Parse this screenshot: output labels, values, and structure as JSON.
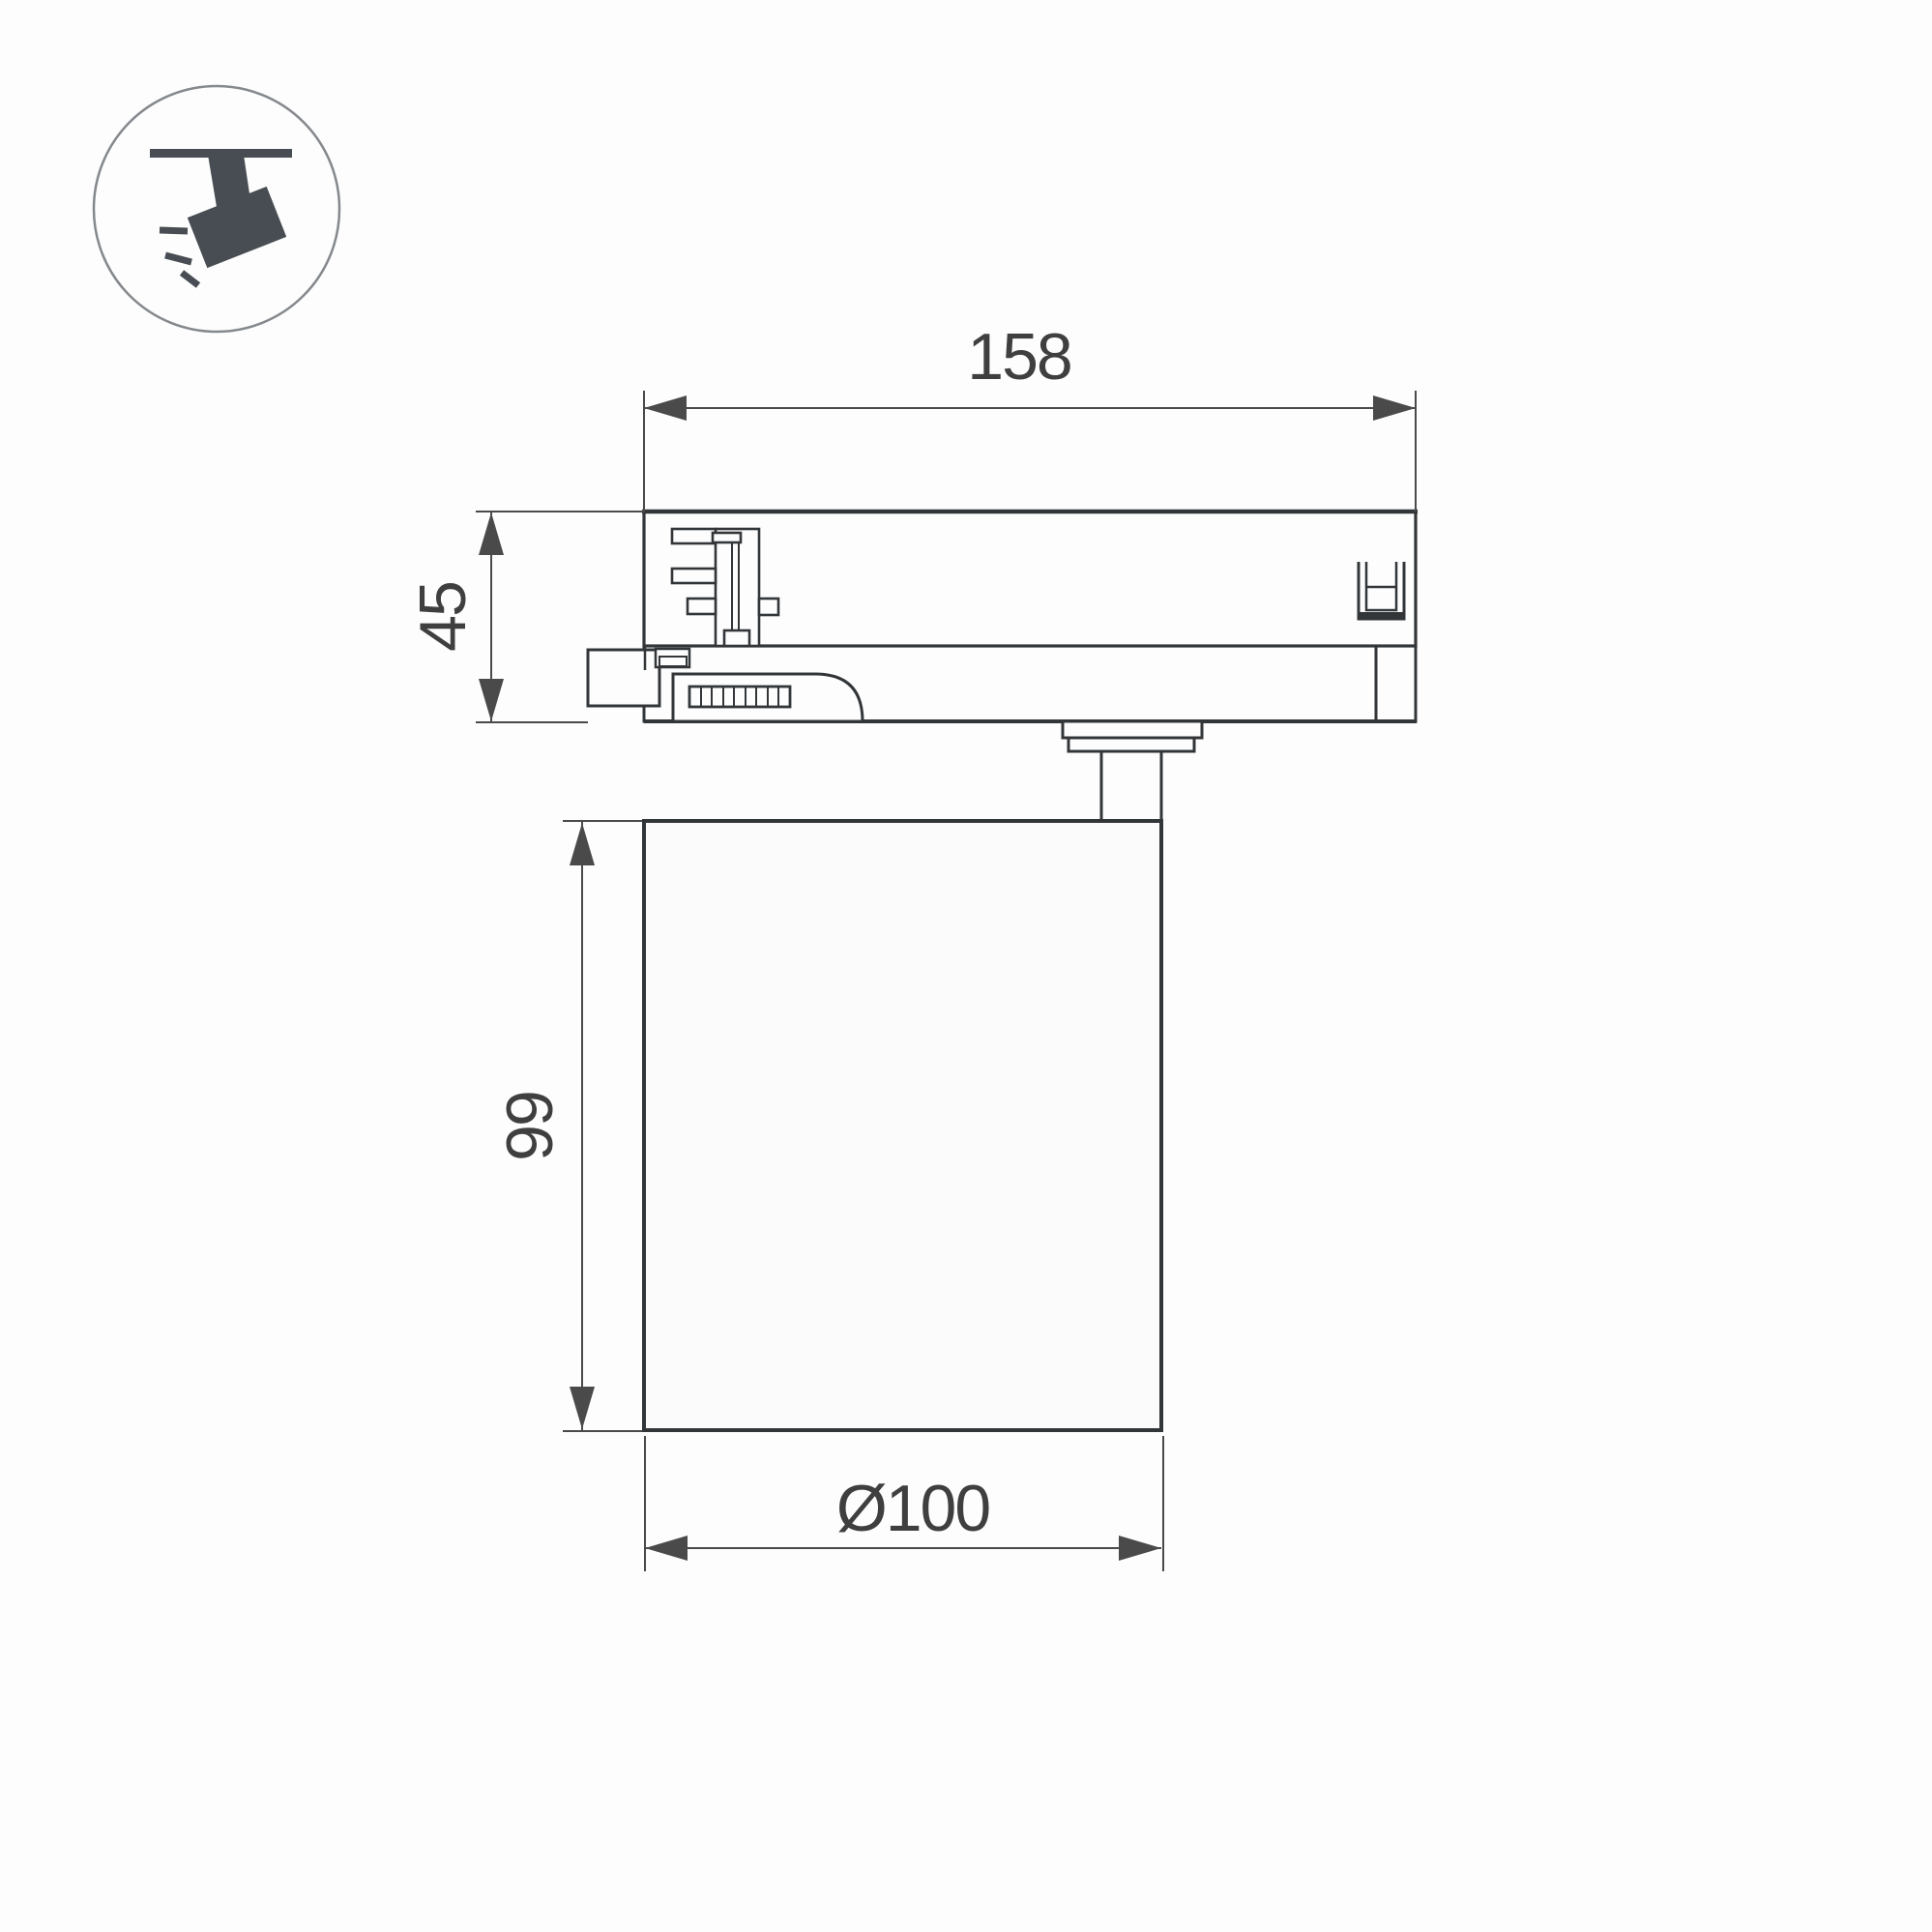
{
  "page": {
    "type": "technical dimension drawing",
    "subject": "3-phase track spotlight luminaire, side view with mounting adapter",
    "background": "#fdfdfd"
  },
  "icon_legend": {
    "name": "track-spotlight-icon",
    "description": "spotlight mounted on ceiling track, tilted, emitting light rays"
  },
  "dimensions": {
    "adapter_length": "158",
    "adapter_height": "45",
    "body_height": "99",
    "body_diameter": "Ø100"
  },
  "colors": {
    "outline": "#333639",
    "dimension_lines": "#4a4a4a",
    "dimension_text": "#3f3f3f",
    "icon_fill": "#474d52",
    "icon_ring": "#85898d",
    "background": "#fdfdfd"
  }
}
